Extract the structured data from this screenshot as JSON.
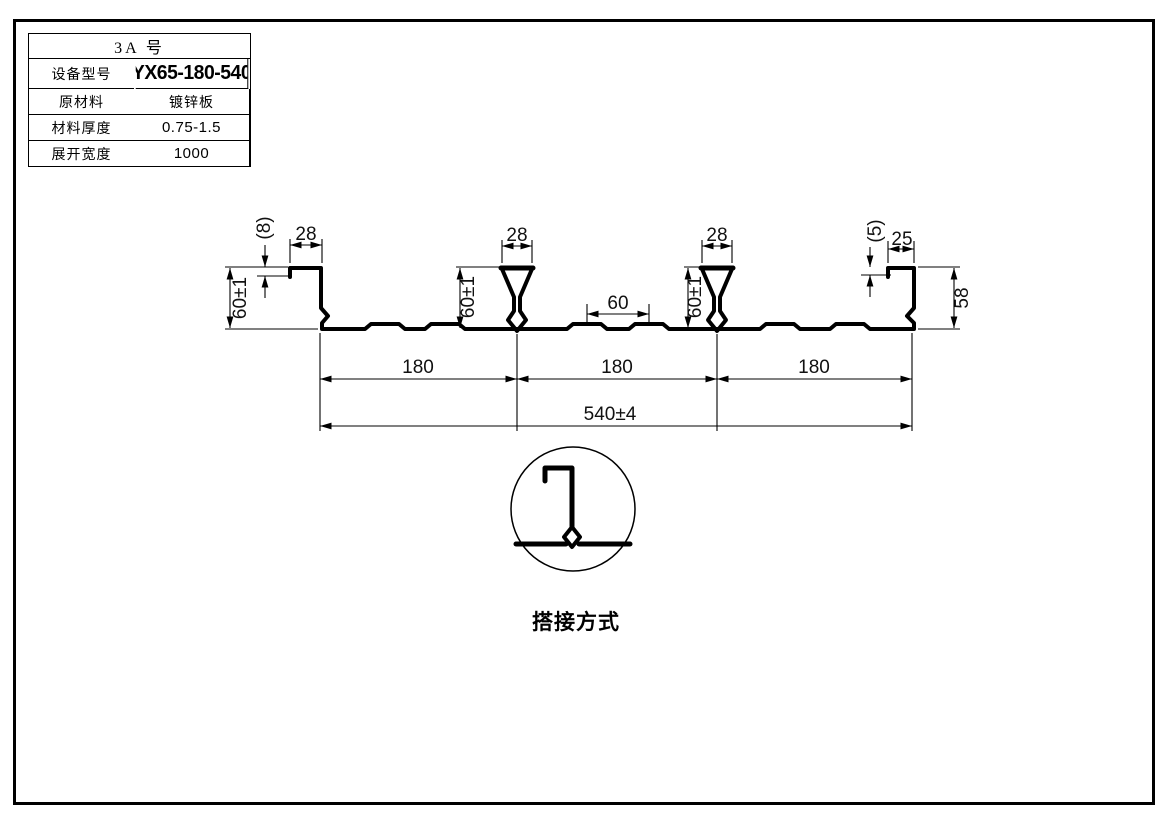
{
  "table": {
    "title": "3A 号",
    "rows": [
      {
        "label": "设备型号",
        "value": "YX65-180-540"
      },
      {
        "label": "原材料",
        "value": "镀锌板"
      },
      {
        "label": "材料厚度",
        "value": "0.75-1.5"
      },
      {
        "label": "展开宽度",
        "value": "1000"
      }
    ]
  },
  "dims": {
    "left_lip": "(8)",
    "left_top_width": "28",
    "left_web_height": "60±1",
    "rib1_top_width": "28",
    "rib1_height": "60±1",
    "emboss_spacing": "60",
    "rib2_top_width": "28",
    "rib2_height": "60±1",
    "right_lip": "(5)",
    "right_top_width": "25",
    "right_web_height": "58",
    "span1": "180",
    "span2": "180",
    "span3": "180",
    "overall_width": "540±4"
  },
  "detail": {
    "label": "搭接方式"
  },
  "colors": {
    "line": "#000000",
    "background": "#ffffff"
  }
}
